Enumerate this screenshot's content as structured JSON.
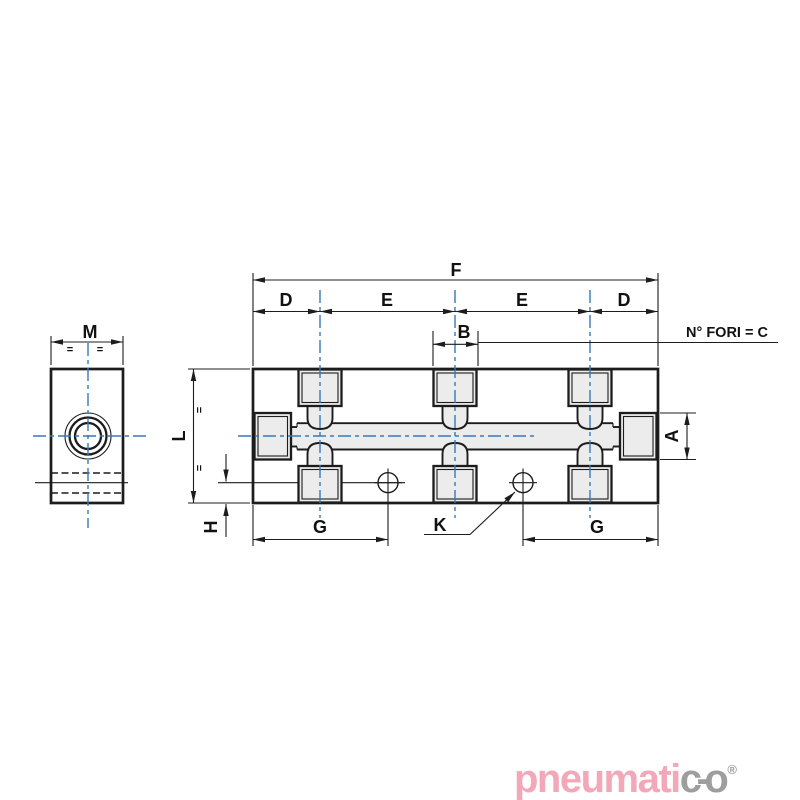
{
  "drawing": {
    "labels": {
      "f": "F",
      "d_left": "D",
      "e_left": "E",
      "e_right": "E",
      "d_right": "D",
      "b": "B",
      "holes_note": "N° FORI = C",
      "m": "M",
      "l": "L",
      "a": "A",
      "h": "H",
      "g_left": "G",
      "g_right": "G",
      "k": "K",
      "eq": "="
    },
    "colors": {
      "centerline_blue": "#3579b8",
      "line_black": "#1c1c1c",
      "fill_light": "#ececec"
    }
  },
  "logo": {
    "part1": "pneumati",
    "part2": "c",
    "dash": "-",
    "part3": "o",
    "reg": "®",
    "color_primary": "#f3a8ba",
    "color_secondary": "#9e9e9e"
  }
}
